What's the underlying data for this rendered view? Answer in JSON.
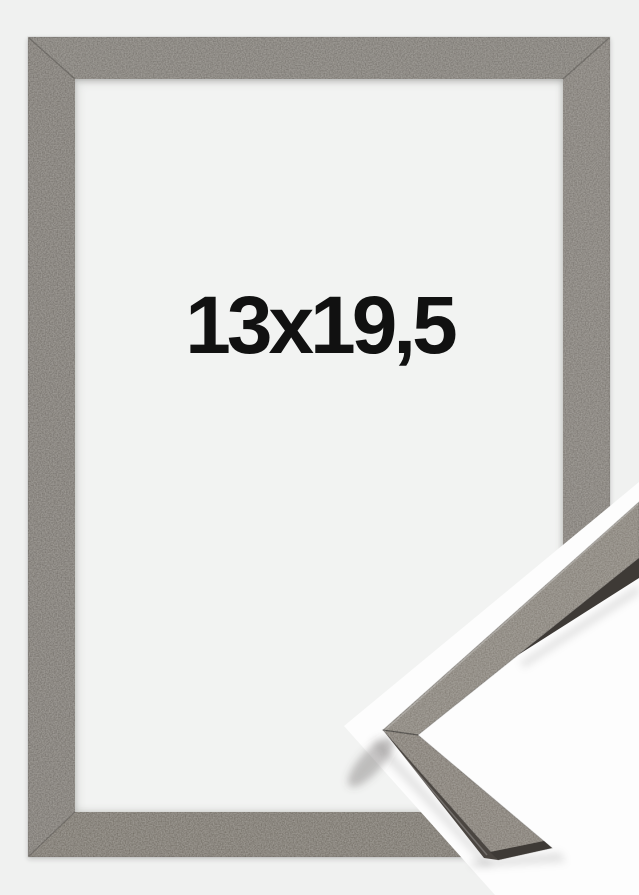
{
  "product_image": {
    "size_label": "13x19,5",
    "colors": {
      "background": "#f0f1f0",
      "mat": "#f2f3f2",
      "cut_band": "#fdfdfd",
      "label": "#111111",
      "frame_top": "#6f6b65",
      "frame_left": "#6c6761",
      "frame_right": "#726d67",
      "frame_bottom": "#696359",
      "corner_face_upper": "#7a746b",
      "corner_face_lower": "#746d64",
      "corner_side": "#4a4540",
      "corner_dark_edge": "#3e3a36"
    }
  }
}
